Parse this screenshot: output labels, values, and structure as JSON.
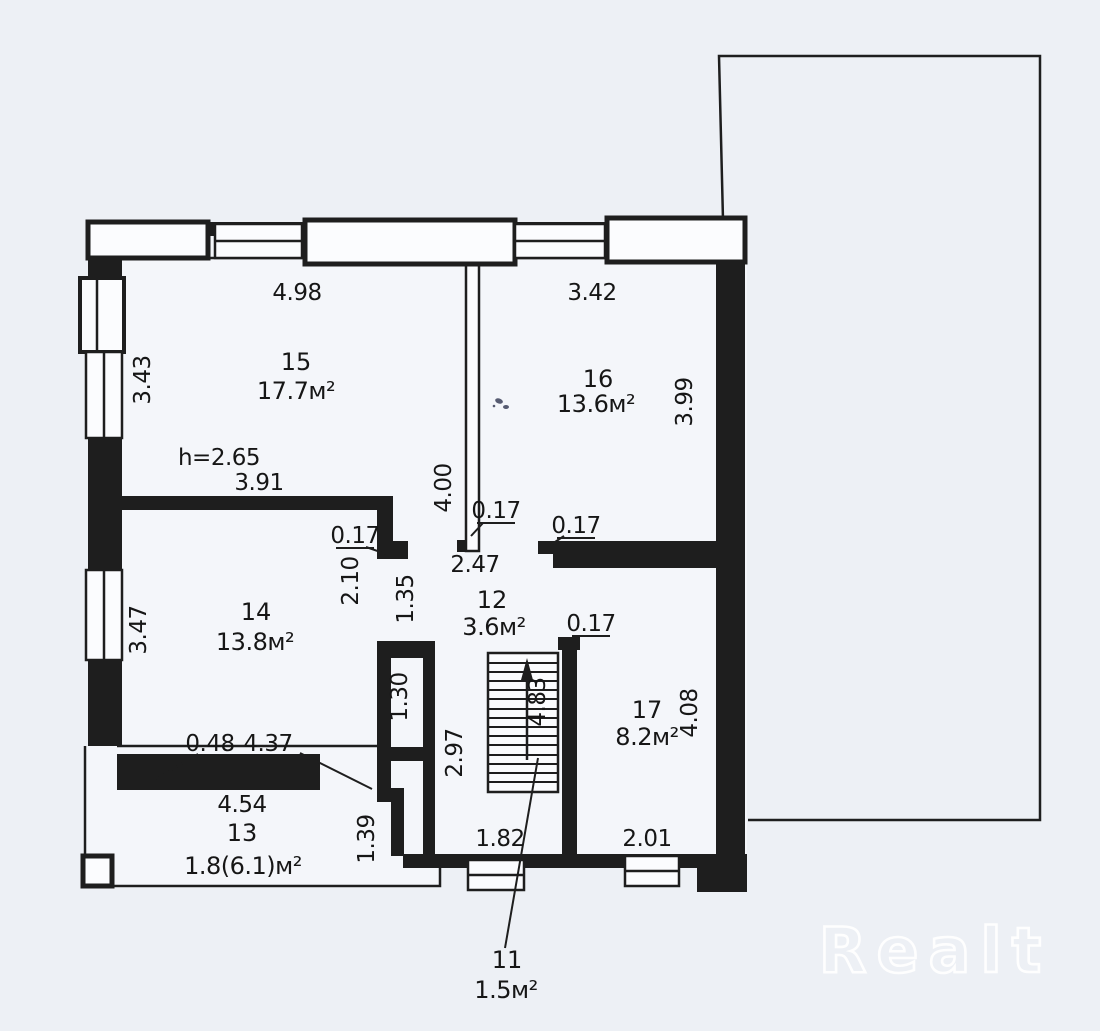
{
  "watermark": "Realt",
  "rooms": [
    {
      "number": "15",
      "area": "17.7м²"
    },
    {
      "number": "16",
      "area": "13.6м²"
    },
    {
      "number": "14",
      "area": "13.8м²"
    },
    {
      "number": "12",
      "area": "3.6м²"
    },
    {
      "number": "17",
      "area": "8.2м²"
    },
    {
      "number": "13",
      "area": "1.8(6.1)м²"
    },
    {
      "number": "11",
      "area": "1.5м²"
    }
  ],
  "dims": {
    "top_left_width": "4.98",
    "top_right_width": "3.42",
    "left_upper_height": "3.43",
    "left_lower_height": "3.47",
    "center_partition_length": "4.00",
    "right_upper_height": "3.99",
    "ceiling_height": "h=2.65",
    "room15_lower_width": "3.91",
    "wall_thickness_a": "0.17",
    "wall_thickness_b": "0.17",
    "wall_thickness_c": "0.17",
    "wall_thickness_d": "0.17",
    "hall_top_width": "2.47",
    "opening_2_10": "2.10",
    "opening_1_35": "1.35",
    "closet_height": "1.30",
    "stair_run": "4.83",
    "stair_hall_height": "2.97",
    "room17_height": "4.08",
    "porch_wall_thickness": "0.48",
    "room14_width": "4.37",
    "porch_width": "4.54",
    "porch_bay_depth": "1.39",
    "stair_hall_width": "1.82",
    "room17_width": "2.01"
  }
}
